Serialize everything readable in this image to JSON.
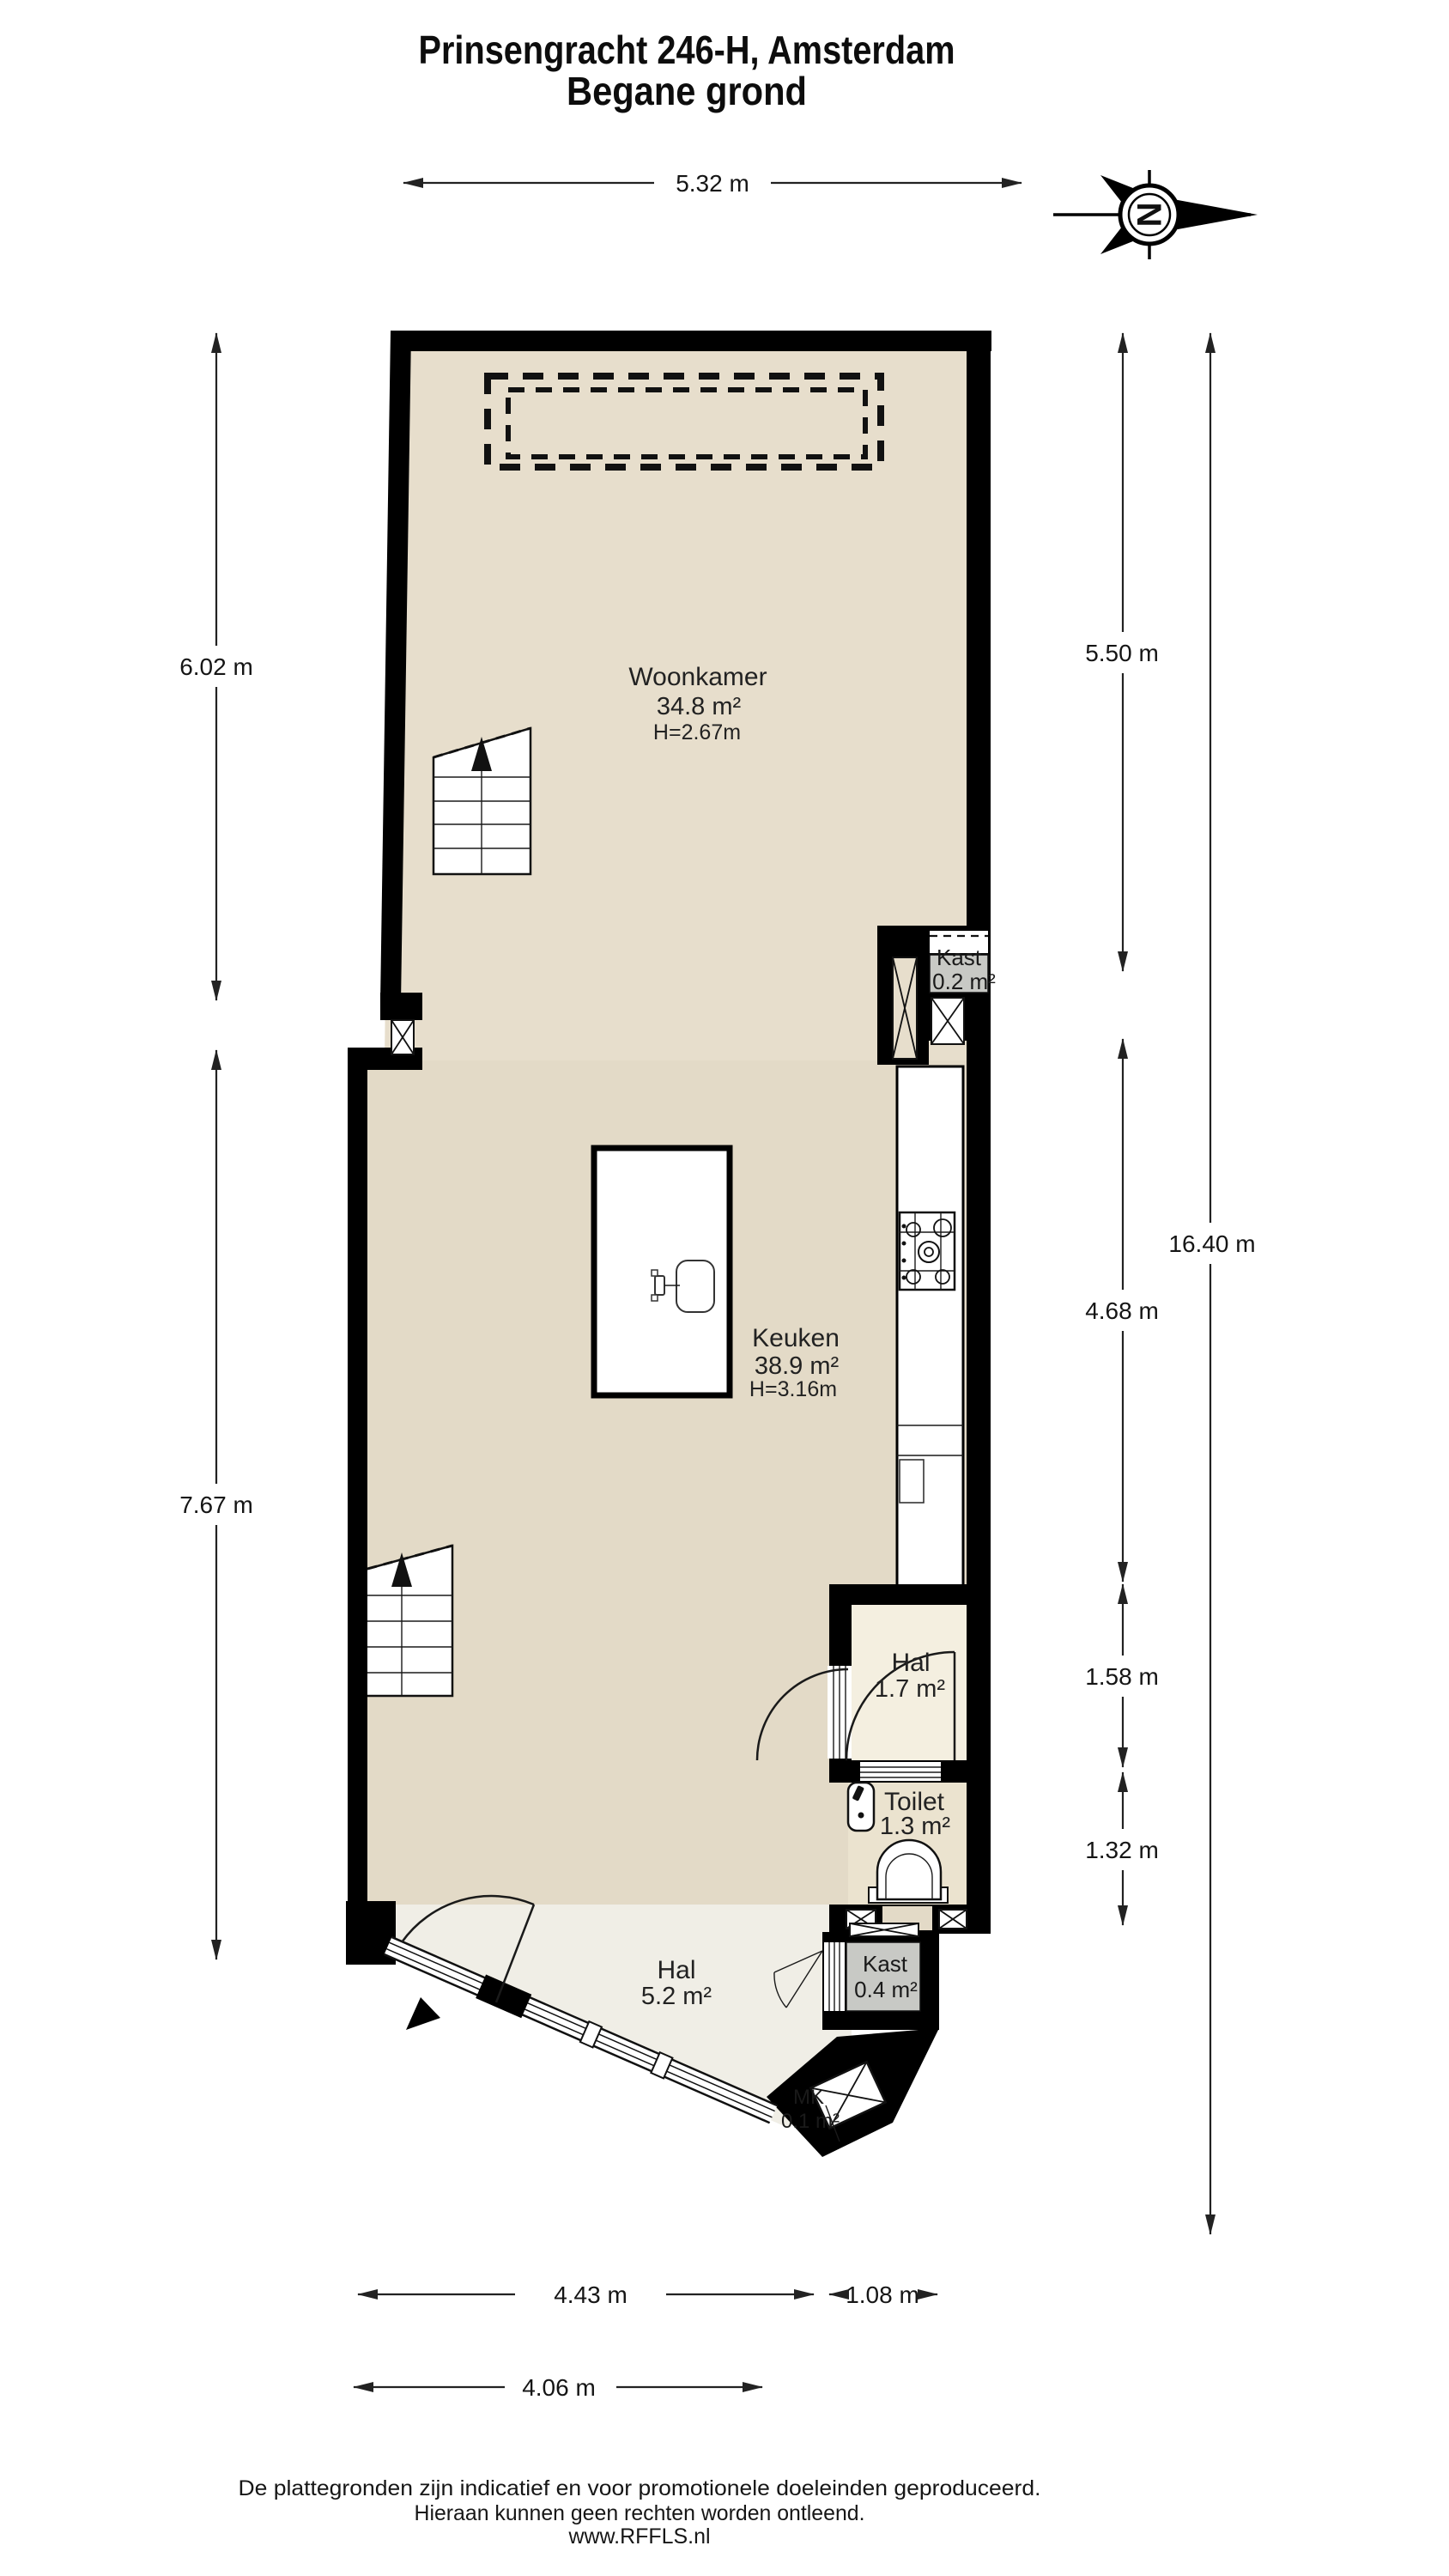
{
  "title": {
    "line1": "Prinsengracht 246-H, Amsterdam",
    "line2": "Begane grond"
  },
  "compass": {
    "letter": "N"
  },
  "rooms": [
    {
      "id": "woonkamer",
      "name": "Woonkamer",
      "area": "34.8 m²",
      "height": "H=2.67m"
    },
    {
      "id": "kast-boven",
      "name": "Kast",
      "area": "0.2 m²"
    },
    {
      "id": "keuken",
      "name": "Keuken",
      "area": "38.9 m²",
      "height": "H=3.16m"
    },
    {
      "id": "hal-midden",
      "name": "Hal",
      "area": "1.7 m²"
    },
    {
      "id": "toilet",
      "name": "Toilet",
      "area": "1.3 m²"
    },
    {
      "id": "hal-entree",
      "name": "Hal",
      "area": "5.2 m²"
    },
    {
      "id": "kast-onder",
      "name": "Kast",
      "area": "0.4 m²"
    },
    {
      "id": "mk",
      "name": "MK",
      "area": "0.1 m²"
    }
  ],
  "dimensions": {
    "top_width": "5.32 m",
    "left_upper": "6.02 m",
    "left_lower": "7.67 m",
    "right_upper": "5.50 m",
    "right_mid": "4.68 m",
    "right_hal": "1.58 m",
    "right_toilet": "1.32 m",
    "right_total": "16.40 m",
    "bottom_main": "4.43 m",
    "bottom_kast": "1.08 m",
    "bottom_lower": "4.06 m"
  },
  "footer": {
    "line1": "De plattegronden zijn indicatief en voor promotionele doeleinden geproduceerd.",
    "line2": "Hieraan kunnen geen rechten worden ontleend.",
    "line3": "www.RFFLS.nl"
  },
  "colors": {
    "wall": "#000000",
    "woonkamer": "#E7DECC",
    "keuken": "#E3DAC7",
    "hal_klein": "#F4EFE0",
    "toilet": "#EBE3CF",
    "hal_entree": "#F0EEE6",
    "kast": "#C8C9C5",
    "achtergrond": "#FFFFFF"
  }
}
